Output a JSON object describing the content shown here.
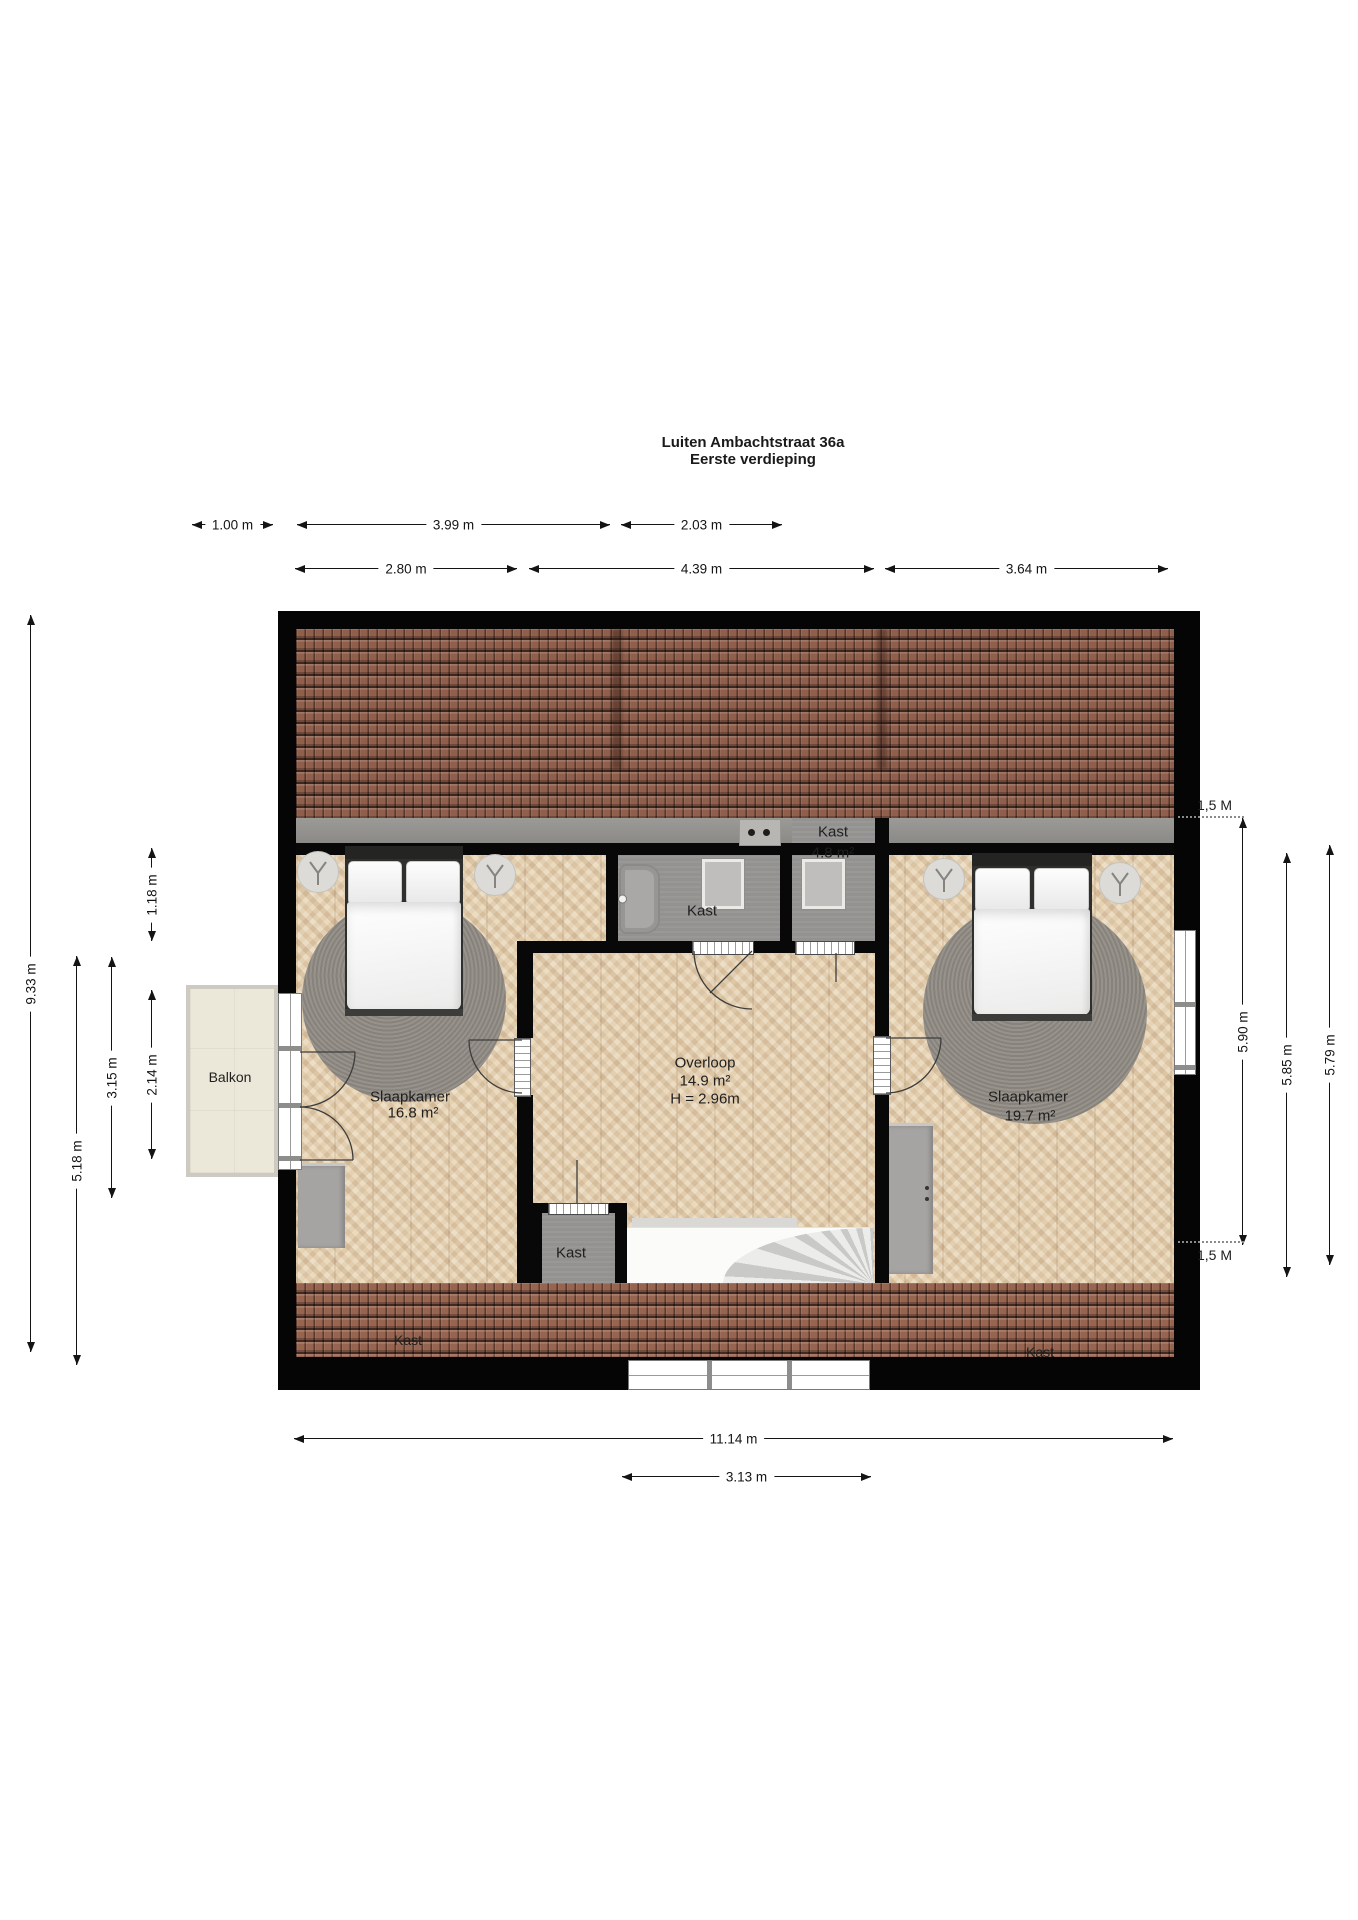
{
  "title": {
    "line1": "Luiten Ambachtstraat 36a",
    "line2": "Eerste verdieping"
  },
  "rooms": {
    "bedroom_left": {
      "name": "Slaapkamer",
      "area": "16.8 m²"
    },
    "landing": {
      "name": "Overloop",
      "area": "14.9 m²",
      "height": "H = 2.96m"
    },
    "bedroom_right": {
      "name": "Slaapkamer",
      "area": "19.7 m²"
    },
    "closet_bath": {
      "name": "Kast"
    },
    "closet_top_right": {
      "name": "Kast",
      "area": "4.8 m²"
    },
    "closet_landing": {
      "name": "Kast"
    },
    "closet_bottom_left": {
      "name": "Kast"
    },
    "closet_bottom_right": {
      "name": "Kast"
    },
    "balcony": {
      "name": "Balkon"
    }
  },
  "dimensions": {
    "top_row1": [
      {
        "label": "1.00 m"
      },
      {
        "label": "3.99 m"
      },
      {
        "label": "2.03 m"
      }
    ],
    "top_row2": [
      {
        "label": "2.80 m"
      },
      {
        "label": "4.39 m"
      },
      {
        "label": "3.64 m"
      }
    ],
    "left": [
      {
        "label": "9.33 m"
      },
      {
        "label": "5.18 m"
      },
      {
        "label": "3.15 m"
      },
      {
        "label": "2.14 m"
      },
      {
        "label": "1.18 m"
      }
    ],
    "right": [
      {
        "label": "5.90 m"
      },
      {
        "label": "5.85 m"
      },
      {
        "label": "5.79 m"
      }
    ],
    "right_markers": [
      {
        "label": "1,5 M"
      },
      {
        "label": "1,5 M"
      }
    ],
    "bottom": [
      {
        "label": "11.14 m"
      },
      {
        "label": "3.13 m"
      }
    ]
  },
  "icons": {
    "ceiling_lamp": "circle with three-spoke glyph",
    "bathtub": "rounded rectangle with tap dot",
    "stove_dots": "two burner dots",
    "cabinet_handles": "two small dots"
  },
  "colors": {
    "wall": "#050505",
    "roof_tile": "#8e5c49",
    "wood_floor": "#e7d3b3",
    "gray_floor": "#939291",
    "balcony_floor": "#ebe7d9",
    "rug": "#8f8b83"
  }
}
